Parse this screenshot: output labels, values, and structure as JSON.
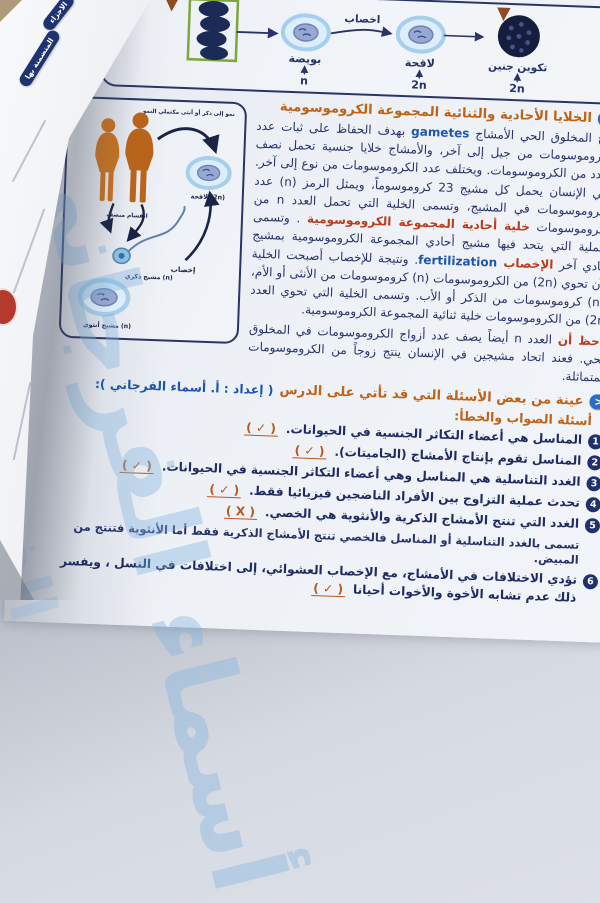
{
  "watermark": {
    "text_large": "أسماء الفرجاني",
    "text_small": "الفرجاني"
  },
  "left_page": {
    "tabs": [
      {
        "label": "الاجزاء"
      },
      {
        "label": "المتضمنة بها"
      }
    ]
  },
  "figure": {
    "chain": {
      "egg_label": "بويضة",
      "egg_ploidy": "n",
      "fert_label": "اخصاب",
      "zygote_label": "لاقحة",
      "zygote_ploidy": "2n",
      "embryo_label": "تكوين جنين",
      "embryo_ploidy": "2n"
    },
    "cycle": {
      "growth_label": "نمو إلى ذكر أو أنثى مكتملي النمو",
      "meiosis_label": "انقسام منصف",
      "zygote_label": "لاقحة (2n)",
      "fert_label": "إخصاب",
      "male_gamete_label": "مشيج ذكري (n)",
      "female_gamete_label": "مشيج أنثوي (n)"
    }
  },
  "heading": {
    "chevron": "<",
    "title": "الخلايا الأحادية والثنائية المجموعة الكروموسومية"
  },
  "paragraph_segments": [
    {
      "t": "ينتج المخلوق الحي الأمشاج ",
      "s": "navy"
    },
    {
      "t": "gametes",
      "s": "blue",
      "dir": "ltr"
    },
    {
      "t": " بهدف الحفاظ على ثبات عدد الكروموسومات من جيل إلى آخر، والأمشاج خلايا جنسية تحمل نصف العدد من الكروموسومات. ويختلف عدد الكروموسومات من نوع إلى آخر. ففي الإنسان يحمل كل مشيج 23 كروموسوماً، ويمثل الرمز (n) عدد الكروموسومات في المشيج، وتسمى الخلية التي تحمل العدد n من الكروموسومات ",
      "s": "navy"
    },
    {
      "t": "خلية أحادية المجموعة الكروموسومية",
      "s": "red"
    },
    {
      "t": " . وتسمى العملية التي يتحد فيها مشيج أحادي المجموعة الكروموسومية بمشيج أحادي آخر ",
      "s": "navy"
    },
    {
      "t": "الإخصاب ",
      "s": "red"
    },
    {
      "t": "fertilization",
      "s": "blue",
      "dir": "ltr"
    },
    {
      "t": ". ونتيجة للإخصاب أصبحت الخلية الآن تحوي (2n) من الكروموسومات (n) كروموسومات من الأنثى أو الأم، و(n) كروموسومات من الذكر أو الأب. وتسمى الخلية التي تحوي العدد (2n) من الكروموسومات خلية ثنائية المجموعة الكروموسومية.",
      "s": "navy"
    }
  ],
  "note_segments": [
    {
      "t": "لاحظ أن",
      "s": "red"
    },
    {
      "t": " العدد n أيضاً يصف عدد أزواج الكروموسومات في المخلوق الحي. فعند اتحاد مشيجين في الإنسان ينتج زوجاً من الكروموسومات المتماثلة.",
      "s": "navy"
    }
  ],
  "section": {
    "chevron": "<",
    "title": "عينة من بعض الأسئلة التي قد تأتي على الدرس",
    "credit": "( إعداد : أ. أسماء الفرجاني ):"
  },
  "quiz_header": "أسئلة الصواب والخطأ:",
  "questions": [
    {
      "num": "1",
      "text": "المناسل هي أعضاء التكاثر الجنسية في الحيوانات.",
      "mark": "( ✓ )"
    },
    {
      "num": "2",
      "text": "المناسل تقوم بإنتاج الأمشاج (الجاميتات).",
      "mark": "( ✓ )"
    },
    {
      "num": "3",
      "text": "الغدد التناسلية هي المناسل وهي أعضاء التكاثر الجنسية في الحيوانات.",
      "mark": "( ✓ )"
    },
    {
      "num": "4",
      "text": "تحدث عملية التزاوج بين الأفراد الناضجين فيزيائيا فقط.",
      "mark": "( ✓ )"
    },
    {
      "num": "5",
      "text": "الغدد التي تنتج الأمشاج الذكرية والأنثوية هي الخصي.",
      "mark": "( X )",
      "explanation": "تسمى بالغدد التناسلية أو المناسل فالخصي تنتج الأمشاج الذكرية فقط أما الأنثوية فتنتج من المبيض."
    },
    {
      "num": "6",
      "text": "تؤدي الاختلافات في الأمشاج، مع الإخصاب العشوائي، إلى اختلافات في النسل ، ويفسر ذلك عدم تشابه الأخوة والأخوات أحيانا",
      "mark": "( ✓ )"
    }
  ],
  "colors": {
    "paper": "#edf1f6",
    "navy_text": "#27326b",
    "heading_orange": "#bf6317",
    "keyword_red": "#bd3c1c",
    "keyword_blue": "#1d55b0",
    "mark_orange": "#bb581d",
    "badge_navy": "#20316e",
    "chevron_blue": "#2e6bc4",
    "figure_border": "#2a3566",
    "cell_ring": "#a5cfec",
    "human_orange": "#c9731f",
    "green_box": "#7ca63e",
    "morula_navy": "#161e3e",
    "watermark_blue": "#7fb3e0"
  }
}
